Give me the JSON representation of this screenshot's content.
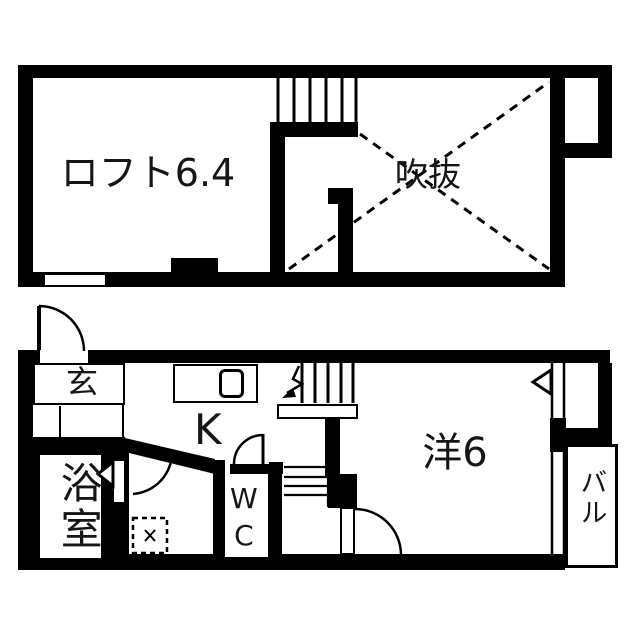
{
  "colors": {
    "wall": "#000000",
    "background": "#ffffff",
    "text": "#161616"
  },
  "floors": [
    {
      "id": "loft-floor",
      "rooms": [
        {
          "id": "loft-room",
          "label": "ロフト6.4"
        },
        {
          "id": "void-space",
          "label": "吹抜"
        }
      ]
    },
    {
      "id": "first-floor",
      "rooms": [
        {
          "id": "entrance",
          "label": "玄"
        },
        {
          "id": "kitchen",
          "label": "K"
        },
        {
          "id": "toilet",
          "label": "WC"
        },
        {
          "id": "bathroom",
          "label": "浴室"
        },
        {
          "id": "western-room",
          "label": "洋6"
        },
        {
          "id": "balcony",
          "label": "バル"
        }
      ]
    }
  ]
}
